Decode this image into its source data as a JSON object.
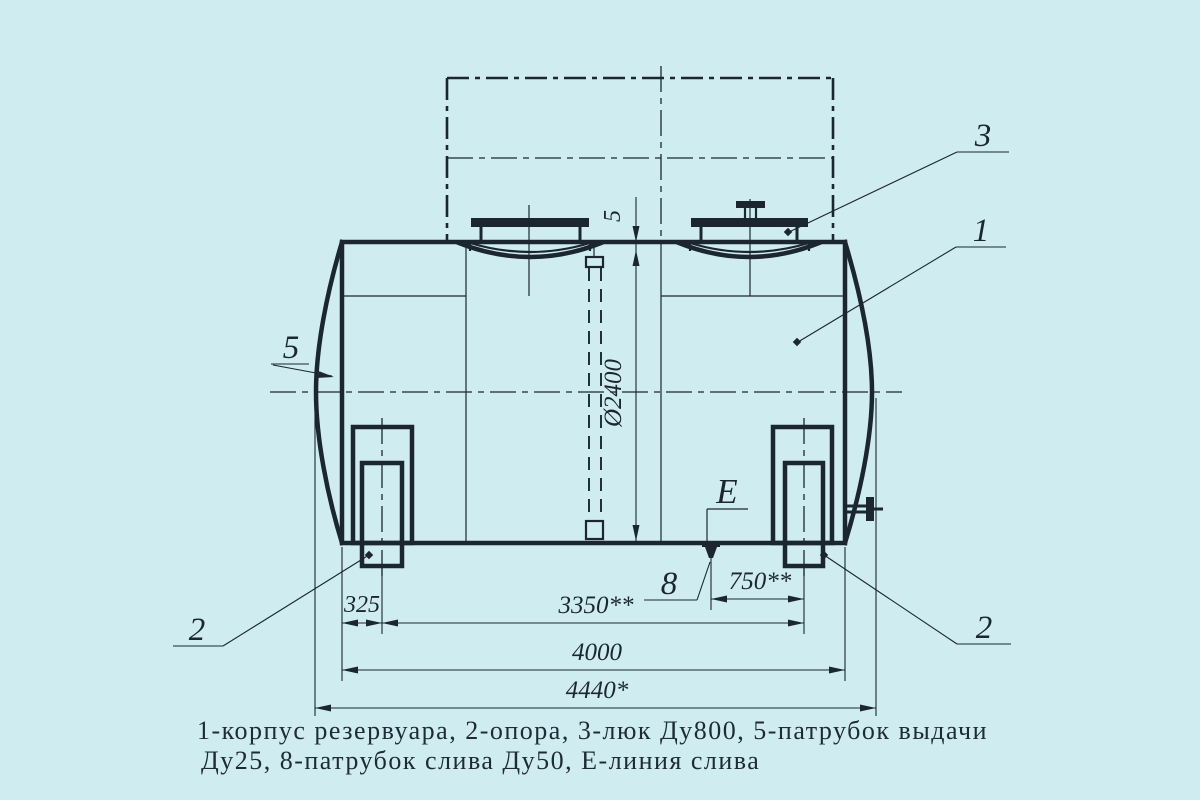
{
  "drawing": {
    "background_color": "#cfedf0",
    "line_color": "#1b2630",
    "dims": {
      "wall": "5",
      "dia": "Ø2400",
      "l325": "325",
      "l3350": "3350**",
      "l750": "750**",
      "l4000": "4000",
      "l4440": "4440*"
    },
    "callouts": {
      "body": "1",
      "support_left": "2",
      "support_right": "2",
      "manhole": "3",
      "outlet": "5",
      "drain": "8",
      "drain_line": "Е"
    },
    "caption": {
      "line1": "1-корпус резервуара, 2-опора, 3-люк Ду800, 5-патрубок выдачи",
      "line2": "Ду25, 8-патрубок слива Ду50, Е-линия слива"
    }
  }
}
